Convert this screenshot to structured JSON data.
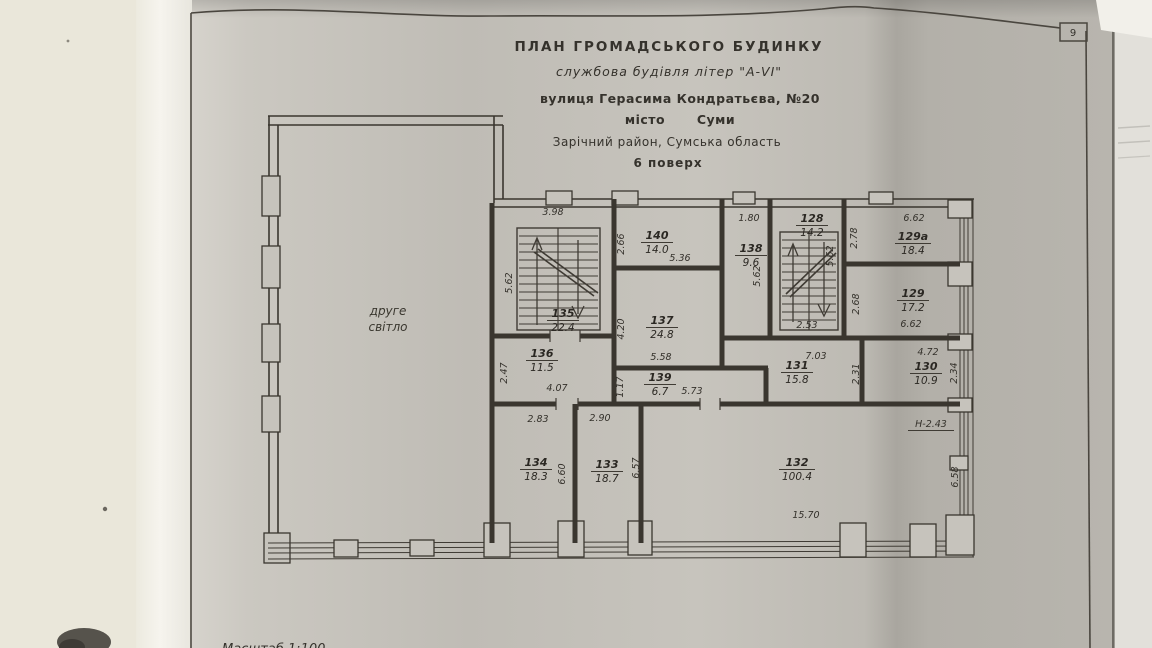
{
  "page": {
    "page_number": "9",
    "scale_note": "Масштаб  1:100"
  },
  "title_block": {
    "line1": "ПЛАН  ГРОМАДСЬКОГО  БУДИНКУ",
    "line2": "службова будівля літер \"А-VI\"",
    "line3": "вулиця  Герасима Кондратьєва, №20",
    "line4_label": "місто",
    "line4_value": "Суми",
    "line5": "Зарічний район, Сумська область",
    "line6": "6 поверх"
  },
  "plan": {
    "atrium_line1": "друге",
    "atrium_line2": "світло",
    "height_note": "Н-2.43",
    "rooms": [
      {
        "number": "135",
        "area": "22.4"
      },
      {
        "number": "136",
        "area": "11.5"
      },
      {
        "number": "140",
        "area": "14.0"
      },
      {
        "number": "137",
        "area": "24.8"
      },
      {
        "number": "139",
        "area": "6.7"
      },
      {
        "number": "138",
        "area": "9.6"
      },
      {
        "number": "128",
        "area": "14.2"
      },
      {
        "number": "129а",
        "area": "18.4"
      },
      {
        "number": "129",
        "area": "17.2"
      },
      {
        "number": "131",
        "area": "15.8"
      },
      {
        "number": "130",
        "area": "10.9"
      },
      {
        "number": "134",
        "area": "18.3"
      },
      {
        "number": "133",
        "area": "18.7"
      },
      {
        "number": "132",
        "area": "100.4"
      }
    ],
    "dims": {
      "r135_w": "3.98",
      "r135_h": "5.62",
      "r136_w": "4.07",
      "r136_h": "2.47",
      "r140_w": "5.36",
      "r140_h": "2.66",
      "r137_w": "5.58",
      "r137_h": "4.20",
      "r139_w": "5.73",
      "r139_h": "1.17",
      "r138_w": "1.80",
      "r138_h": "5.62",
      "r128_w": "2.53",
      "r128_h": "5.62",
      "r129a_w": "6.62",
      "r129a_h": "2.78",
      "r129_w": "6.62",
      "r129_h": "2.68",
      "r131_w": "7.03",
      "r131_h": "2.31",
      "r130_w": "4.72",
      "r130_h": "2.34",
      "r134_w": "2.83",
      "r134_h": "6.60",
      "r133_w": "2.90",
      "r133_h": "6.57",
      "r132_w": "15.70",
      "r132_h": "6.58"
    }
  }
}
